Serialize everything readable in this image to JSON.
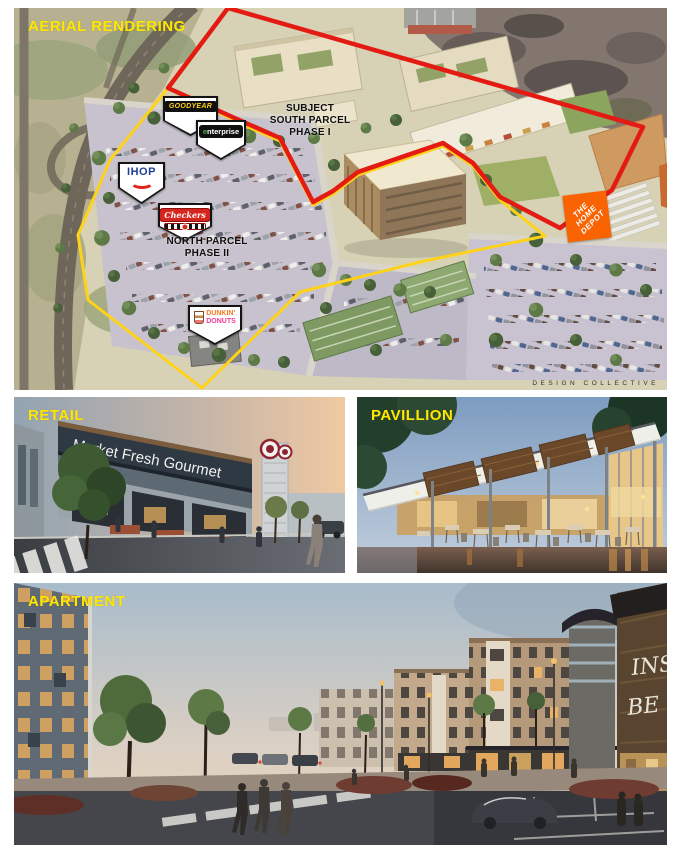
{
  "aerial": {
    "label": "AERIAL RENDERING",
    "subject_parcel": {
      "line1": "SUBJECT",
      "line2": "SOUTH PARCEL",
      "line3": "PHASE I"
    },
    "north_parcel": {
      "line1": "NORTH PARCEL",
      "line2": "PHASE II"
    },
    "credit": "DESIGN COLLECTIVE",
    "boundaries": {
      "subject_color": "#e31b12",
      "north_color": "#ffd21a"
    },
    "pins": {
      "goodyear": "GOODYEAR",
      "enterprise": "enterprise",
      "ihop": "IHOP",
      "checkers": "Checkers",
      "dunkin_line1": "DUNKIN'",
      "dunkin_line2": "DONUTS",
      "home_depot_line1": "THE",
      "home_depot_line2": "HOME",
      "home_depot_line3": "DEPOT"
    }
  },
  "retail": {
    "label": "RETAIL",
    "sign": "Market Fresh Gourmet"
  },
  "pavillion": {
    "label": "PAVILLION"
  },
  "apartment": {
    "label": "APARTMENT",
    "sign_line1": "INS",
    "sign_line2": "BE"
  }
}
